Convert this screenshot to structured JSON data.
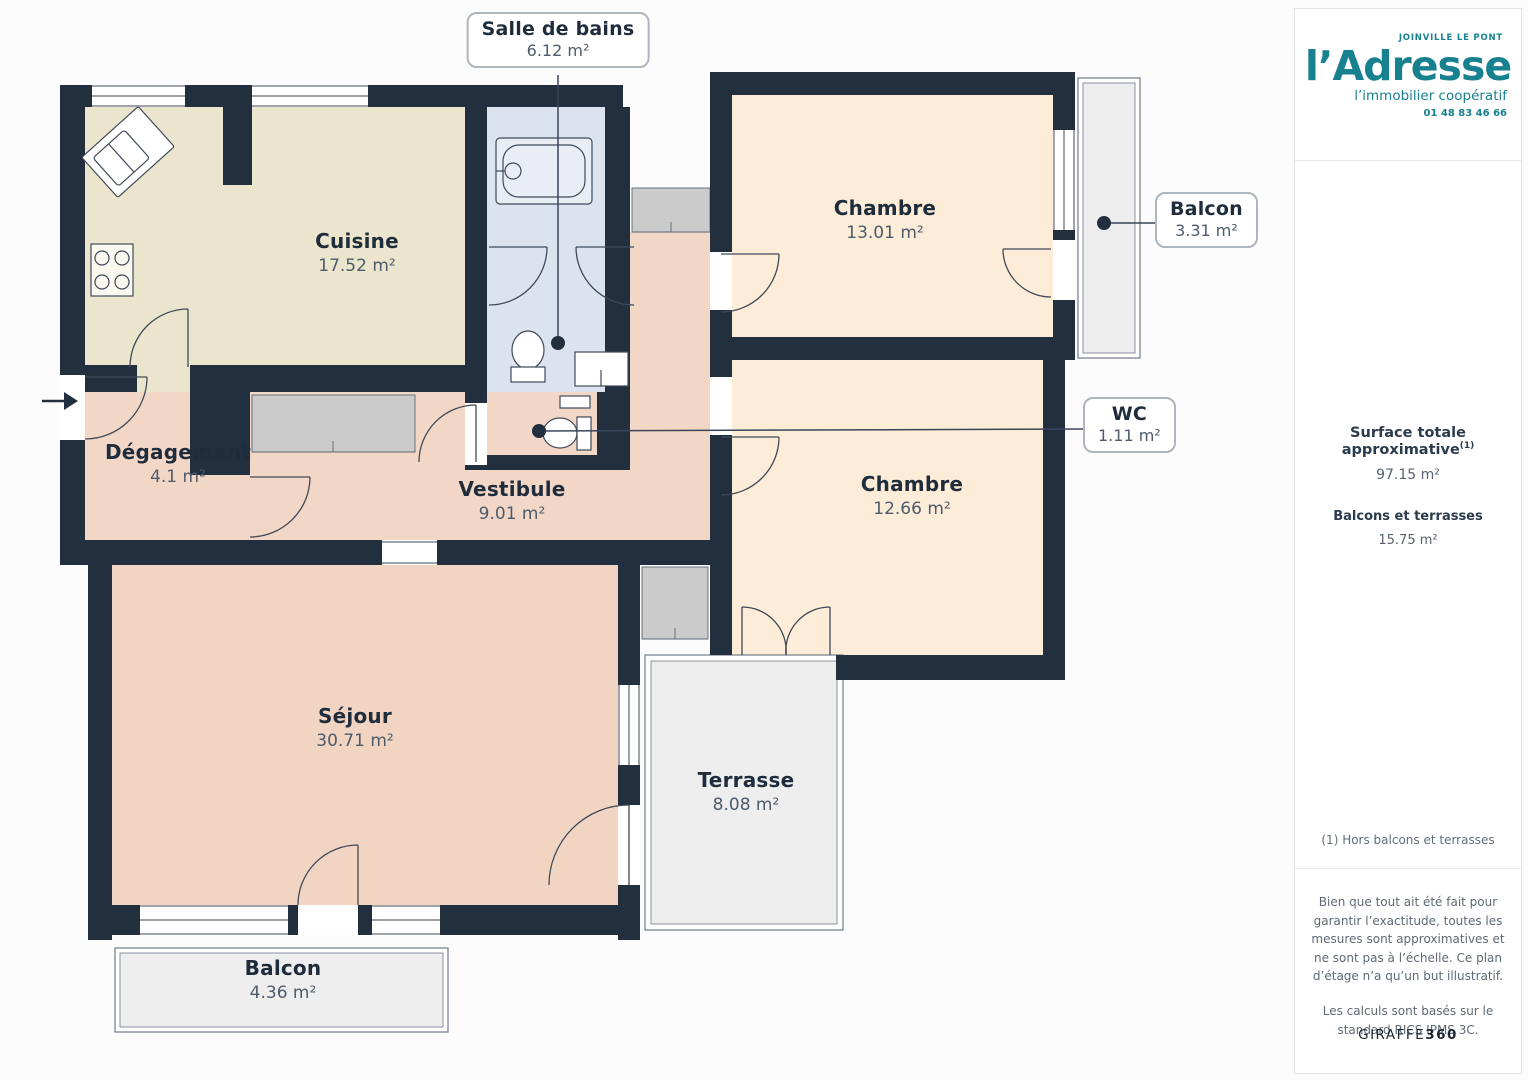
{
  "rooms": {
    "cuisine": {
      "name": "Cuisine",
      "area": "17.52 m²"
    },
    "sdb": {
      "name": "Salle de bains",
      "area": "6.12 m²"
    },
    "chambre1": {
      "name": "Chambre",
      "area": "13.01 m²"
    },
    "balcon1": {
      "name": "Balcon",
      "area": "3.31 m²"
    },
    "wc": {
      "name": "WC",
      "area": "1.11 m²"
    },
    "chambre2": {
      "name": "Chambre",
      "area": "12.66 m²"
    },
    "degagement": {
      "name": "Dégagement",
      "area": "4.1 m²"
    },
    "vestibule": {
      "name": "Vestibule",
      "area": "9.01 m²"
    },
    "sejour": {
      "name": "Séjour",
      "area": "30.71 m²"
    },
    "terrasse": {
      "name": "Terrasse",
      "area": "8.08 m²"
    },
    "balcon2": {
      "name": "Balcon",
      "area": "4.36 m²"
    }
  },
  "sidebar": {
    "logo": {
      "city": "JOINVILLE LE PONT",
      "brand": "l’Adresse",
      "tagline": "l’immobilier coopératif",
      "phone": "01 48 83 46 66"
    },
    "surface": {
      "title": "Surface totale approximative",
      "title_sup": "(1)",
      "value": "97.15 m²",
      "balconies_label": "Balcons et terrasses",
      "balconies_value": "15.75 m²"
    },
    "note": "(1) Hors balcons et terrasses",
    "disclaimer": "Bien que tout ait été fait pour garantir l’exactitude, toutes les mesures sont approximatives et ne sont pas à l’échelle. Ce plan d’étage n’a qu’un but illustratif.",
    "standard": "Les calculs sont basés sur le standard RICS IPMS 3C.",
    "brand_footer": {
      "name": "GIRAFFE",
      "suffix": "360"
    }
  },
  "colors": {
    "wall": "#212f3f",
    "cuisine": "#ece5cd",
    "bathroom": "#dde3ee",
    "chambre": "#fdecd8",
    "salmon": "#f3d7c6",
    "sejour": "#f2d4c2",
    "outdoor": "#eeeeef",
    "closet": "#cbcbcb",
    "accent_teal": "#17818f"
  }
}
